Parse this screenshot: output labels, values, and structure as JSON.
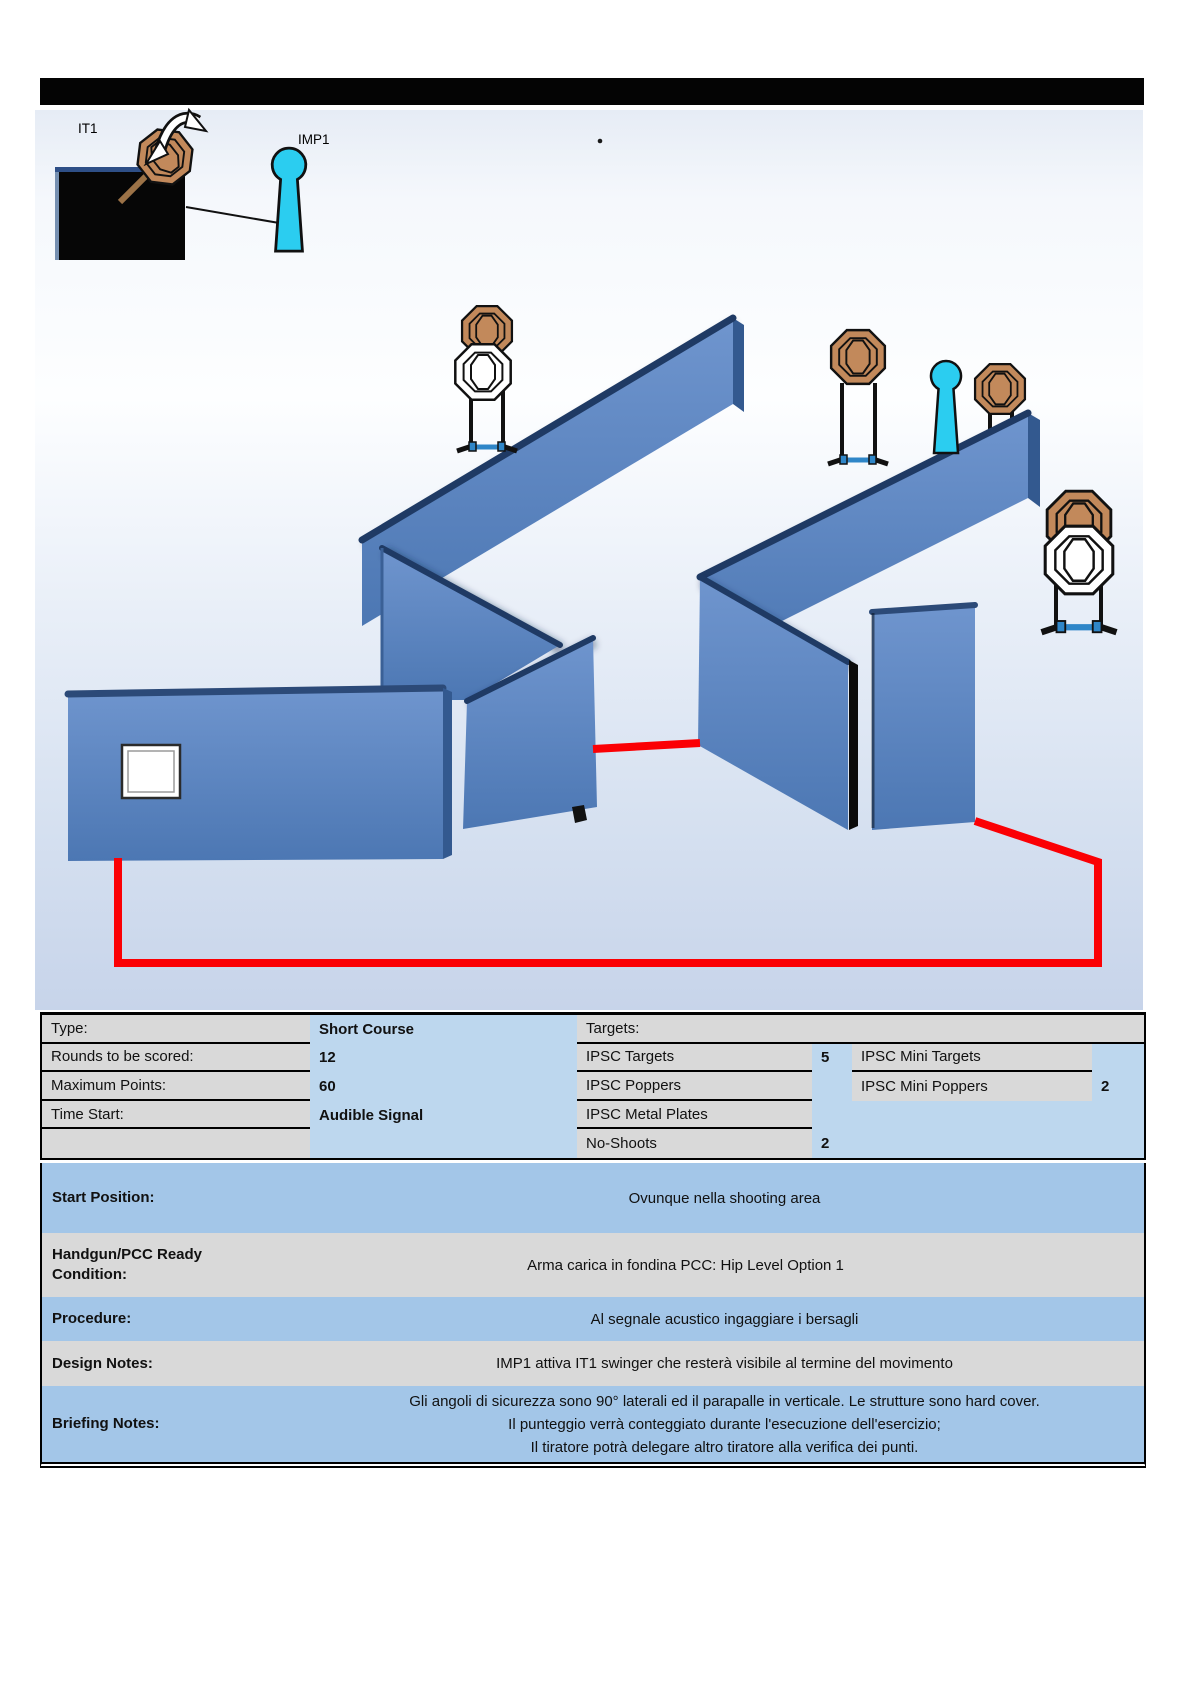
{
  "legend": {
    "swinger_label": "IT1",
    "popper_label": "IMP1"
  },
  "info_table": {
    "targets_header": "Targets:",
    "left_rows": [
      {
        "label": "Type:",
        "value": "Short Course"
      },
      {
        "label": "Rounds to be scored:",
        "value": "12"
      },
      {
        "label": "Maximum Points:",
        "value": "60"
      },
      {
        "label": "Time Start:",
        "value": "Audible Signal"
      },
      {
        "label": "",
        "value": ""
      }
    ],
    "target_rows": [
      {
        "label": "IPSC Targets",
        "count": "5",
        "mini_label": "IPSC Mini Targets",
        "mini_count": ""
      },
      {
        "label": "IPSC Poppers",
        "count": "",
        "mini_label": "IPSC Mini Poppers",
        "mini_count": "2"
      },
      {
        "label": "IPSC Metal Plates",
        "count": "",
        "mini_label": "",
        "mini_count": ""
      },
      {
        "label": "No-Shoots",
        "count": "2",
        "mini_label": "",
        "mini_count": ""
      }
    ]
  },
  "sections": [
    {
      "label": "Start Position:",
      "value": "Ovunque nella shooting area"
    },
    {
      "label": "Handgun/PCC Ready Condition:",
      "value": "Arma carica in fondina PCC: Hip Level Option 1"
    },
    {
      "label": "Procedure:",
      "value": "Al segnale acustico ingaggiare i bersagli"
    },
    {
      "label": "Design Notes:",
      "value": "IMP1  attiva IT1 swinger che resterà visibile al termine del movimento"
    },
    {
      "label": "Briefing Notes:",
      "lines": [
        "Gli angoli di sicurezza sono 90° laterali ed il parapalle in verticale. Le strutture sono hard cover.",
        "Il punteggio verrà conteggiato durante l'esecuzione dell'esercizio;",
        "Il tiratore potrà delegare altro tiratore alla verifica dei punti."
      ]
    }
  ],
  "colors": {
    "wall_blue": "#5B87C6",
    "ridge_navy": "#1F3A64",
    "fault_line_red": "#FB0004",
    "popper_cyan": "#2BCDF0",
    "target_brown": "#C2895B",
    "no_shoot_white": "#FFFFFF",
    "label_gray": "#D9D9D9",
    "value_blue": "#BDD7EE",
    "section_blue": "#A3C6E8",
    "header_bar_black": "#040404"
  }
}
